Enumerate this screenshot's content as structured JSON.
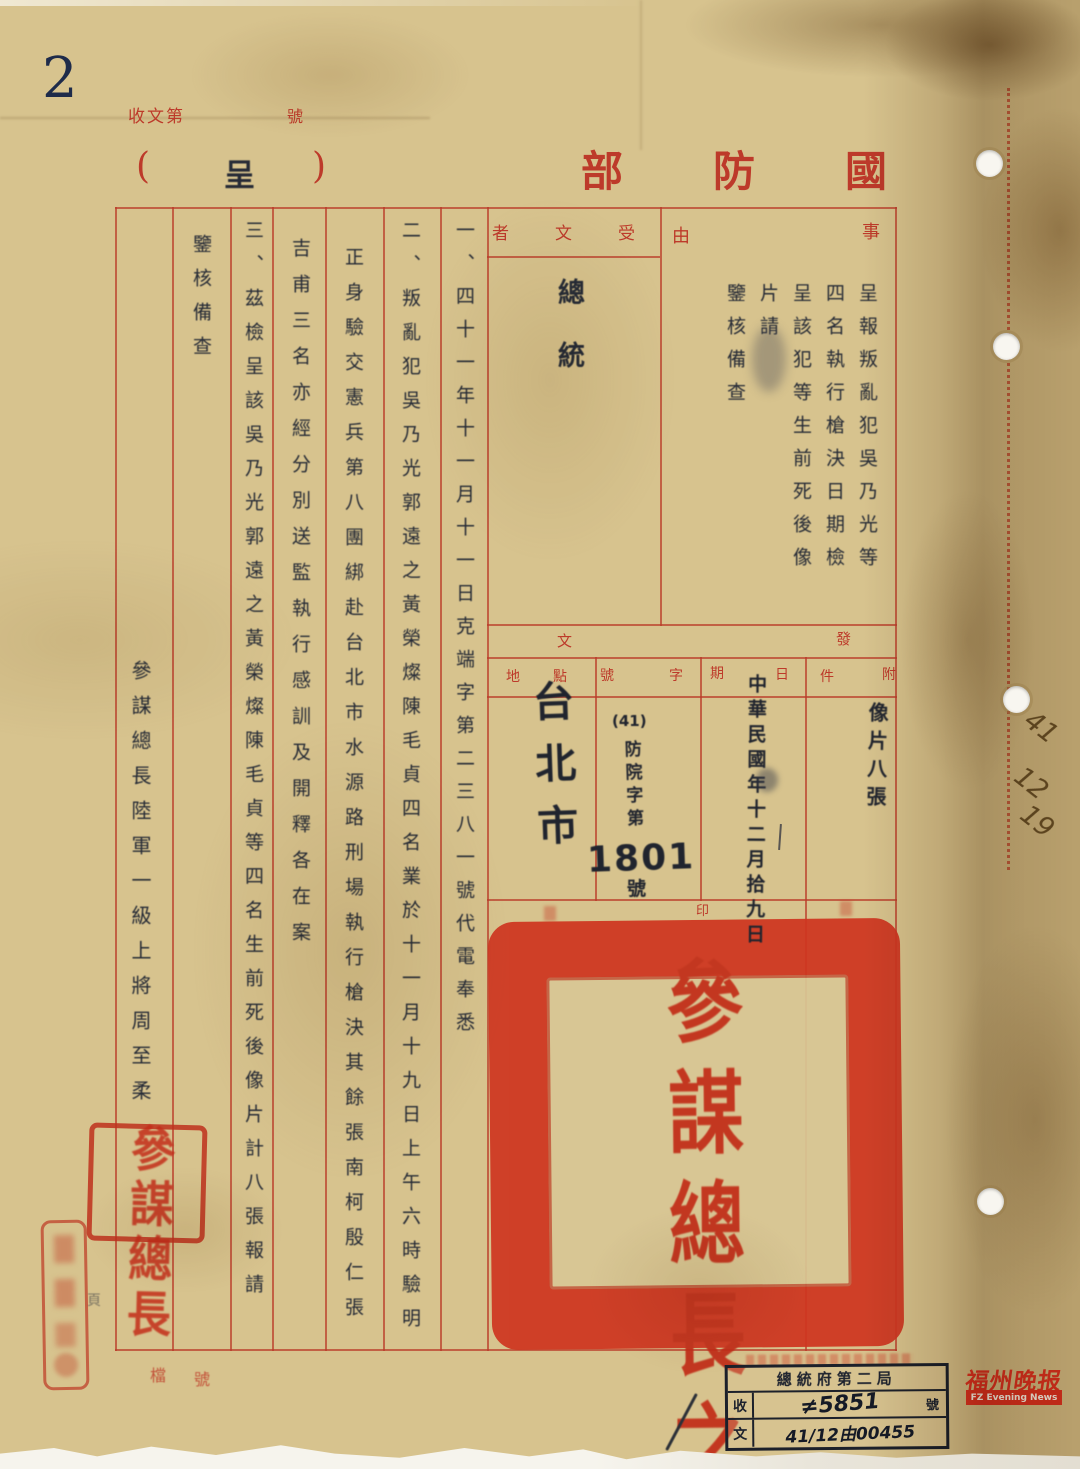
{
  "colors": {
    "paper": "#d7c38e",
    "form_red": "#bd3a2a",
    "seal_red": "#cf3620",
    "ink_black": "#262b36",
    "logo_red": "#e23420"
  },
  "page": {
    "corner_number": "2",
    "margin_date": [
      "41",
      "12",
      "19"
    ],
    "page_char": "頁"
  },
  "letterhead": {
    "receipt_left": "收文第",
    "receipt_right": "號",
    "paren_open": "(",
    "doc_type": "呈",
    "paren_close": ")",
    "ministry": "國防部",
    "ministry_visual": "部防國"
  },
  "form": {
    "subject_label": "事由",
    "subject_label_chars": [
      "事",
      "由"
    ],
    "subject_columns": [
      "呈報叛亂犯吳乃光等",
      "四名執行槍決日期檢",
      "呈該犯等生前死後像",
      "片請",
      "鑒核備查"
    ],
    "recipient_label": "受文者",
    "recipient_label_visual": "者文受",
    "recipient": "總統",
    "body_columns": [
      "一、四十一年十一月十一日克端字第二三八一號代電奉悉",
      "二、叛亂犯吳乃光郭遠之黃榮燦陳毛貞四名業於十一月十九日上午六時驗明",
      "正身驗交憲兵第八團綁赴台北市水源路刑場執行槍決其餘張南柯殷仁張",
      "吉甫三名亦經分別送監執行感訓及開釋各在案",
      "三、茲檢呈該吳乃光郭遠之黃榮燦陳毛貞等四名生前死後像片計八張報請",
      "鑒核備查"
    ],
    "signature": "參謀總長陸軍一級上將周至柔"
  },
  "dispatch": {
    "header": "發文",
    "header_chars": [
      "發",
      "文"
    ],
    "location": {
      "label": "地點",
      "label_chars": [
        "地",
        "點"
      ],
      "value": "台北市"
    },
    "number": {
      "label": "字號",
      "label_chars": [
        "字",
        "號"
      ],
      "prefix": "(41)",
      "series": "防院字第",
      "number": "1801",
      "suffix": "號"
    },
    "date": {
      "label": "日期",
      "label_chars": [
        "日",
        "期"
      ],
      "value": "中華民國年十二月拾九日"
    },
    "attachment": {
      "label": "附件",
      "label_chars": [
        "附",
        "件"
      ],
      "value": "像片八張"
    },
    "seal_label": "印",
    "seal_text": "參謀總長之印"
  },
  "stamps": {
    "square_seal_text": "參謀總長",
    "archive_label": "檔號",
    "archive_label_chars": [
      "檔",
      "號"
    ],
    "received": {
      "title": "總統府第二局",
      "row2_label": "收",
      "row2_value": "≠5851",
      "row2_suffix": "號",
      "row3_label": "文",
      "row3_value": "41/12由00455"
    }
  },
  "logo": {
    "cn": "福州晚报",
    "en": "FZ Evening News"
  }
}
